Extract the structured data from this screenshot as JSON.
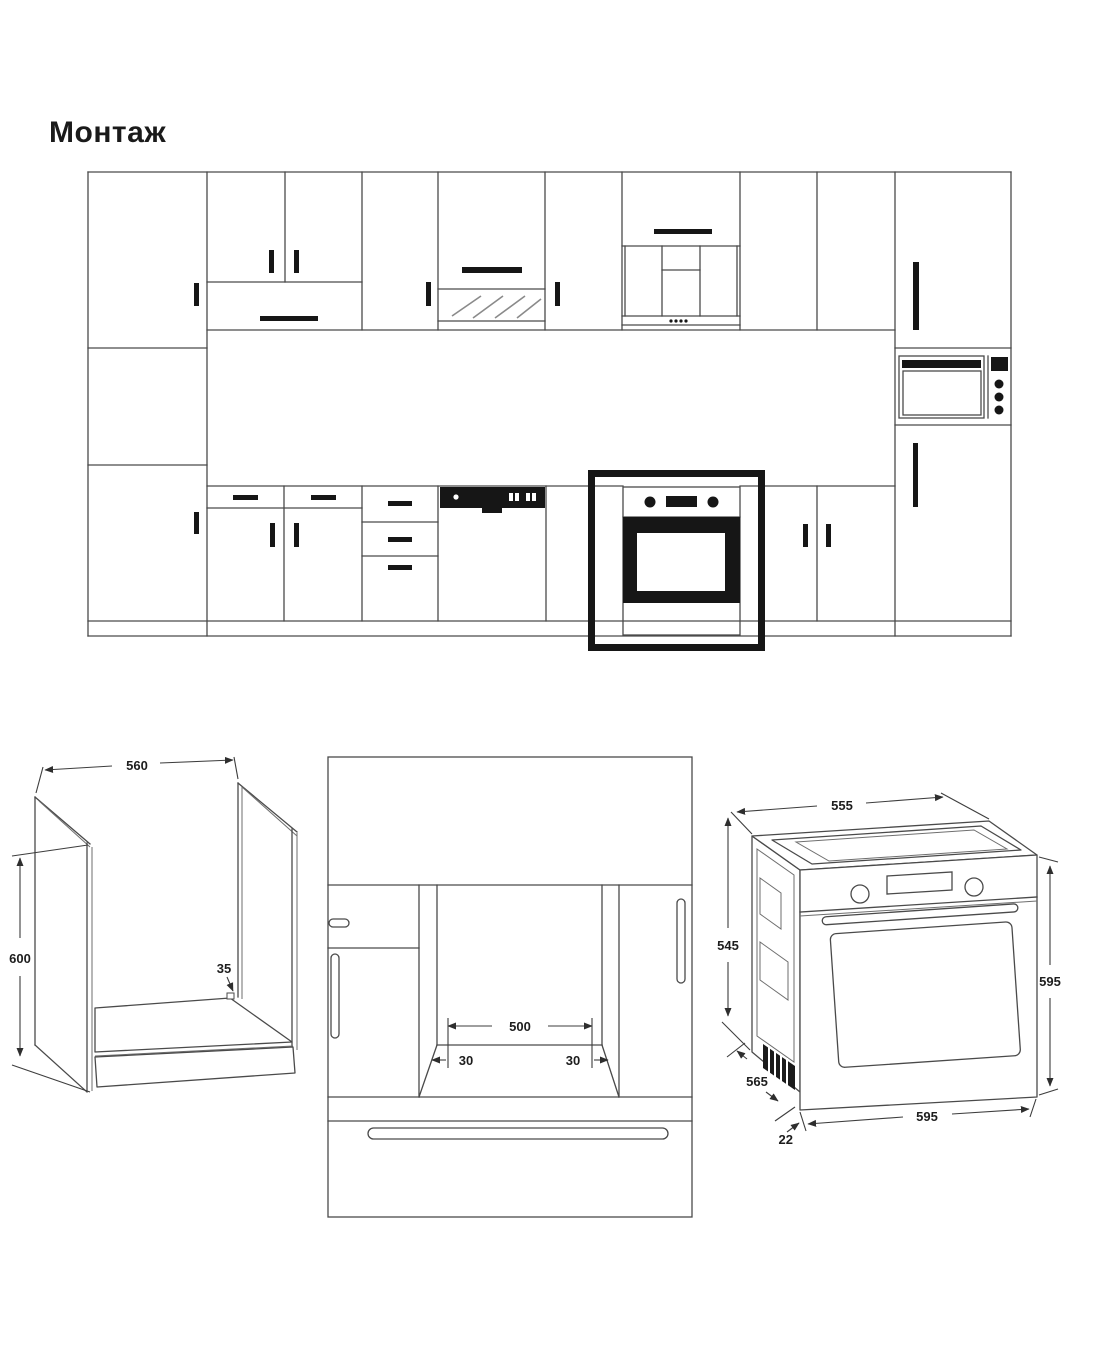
{
  "page": {
    "title": "Монтаж"
  },
  "dims": {
    "niche_iso": {
      "width": "560",
      "height": "600",
      "rear_gap": "35"
    },
    "niche_front": {
      "opening_width": "500",
      "left_margin": "30",
      "right_margin": "30"
    },
    "oven_iso": {
      "top_width": "555",
      "body_height": "545",
      "depth": "565",
      "front_height": "595",
      "front_width": "595",
      "door_protrusion": "22"
    }
  },
  "colors": {
    "line": "#4a4a4a",
    "dark": "#161616",
    "background": "#ffffff",
    "highlight_frame": "#161616"
  }
}
